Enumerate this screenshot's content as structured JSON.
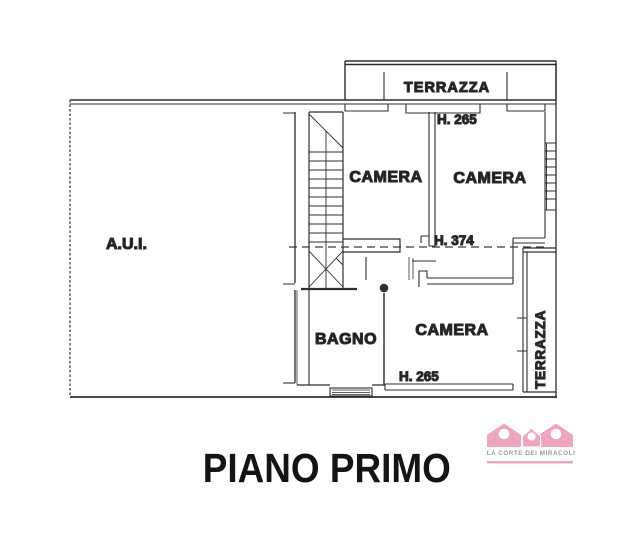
{
  "plan": {
    "title": "PIANO PRIMO",
    "labels": {
      "terrazza_top": "TERRAZZA",
      "camera_top_left": "CAMERA",
      "camera_top_right": "CAMERA",
      "camera_bottom": "CAMERA",
      "bagno": "BAGNO",
      "aui": "A.U.I.",
      "terrazza_right": "TERRAZZA"
    },
    "heights": {
      "camera_top_right": "H. 265",
      "stairwell": "H. 374",
      "camera_bottom": "H. 265"
    },
    "line_color": "#2e2e2e"
  },
  "logo": {
    "name": "LA CORTE DEI MIRACOLI",
    "icon": "three-houses-icon",
    "accent_color": "#efa5bd",
    "text_color": "#9b9b9b"
  },
  "page": {
    "background": "#ffffff"
  }
}
